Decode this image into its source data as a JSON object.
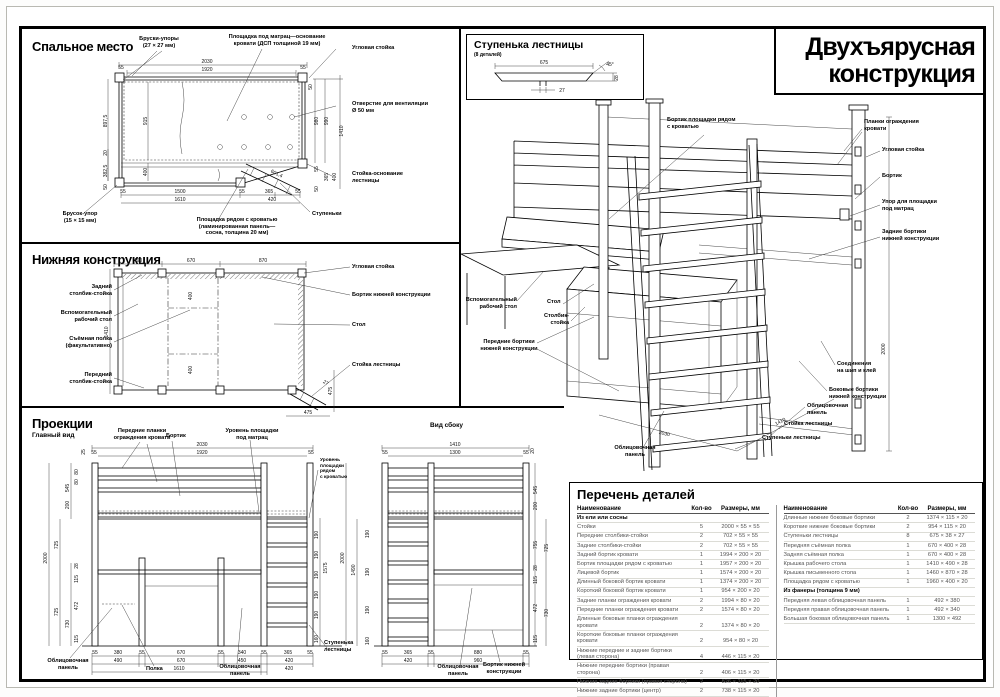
{
  "sheet": {
    "title_line1": "Двухъярусная",
    "title_line2": "конструкция"
  },
  "sleeping": {
    "title": "Спальное место",
    "labels": {
      "bruski_upory": "Бруски-упоры\n(27 × 27 мм)",
      "ploshchadka_matrats": "Площадка под матрац—основание\nкровати (ДСП толщиной 19 мм)",
      "uglovaya_stoyka": "Угловая стойка",
      "otverstie": "Отверстие для вентиляции\nØ 50 мм",
      "stoyka_osnovanie": "Стойка-основание\nлестницы",
      "stupenki": "Ступеньки",
      "brusok_upor": "Брусок-упор\n(15 × 15 мм)",
      "ploshchadka_ryadom": "Площадка рядом с кроватью\n(ламинированная панель—\nсосна, толщина 20 мм)"
    },
    "dims": {
      "w_total": "2030",
      "w_inner": "1920",
      "end55a": "55",
      "end55b": "55",
      "t50": "50",
      "h980": "980",
      "h990": "990",
      "h1410": "1410",
      "r55": "55",
      "r365": "365",
      "r400": "400",
      "r50": "50",
      "l8975": "897,5",
      "l915": "915",
      "l3825": "382,5",
      "l20": "20",
      "l400": "400",
      "l50": "50",
      "b55a": "55",
      "b1500": "1500",
      "b55b": "55",
      "b365": "365",
      "b55c": "55",
      "b1610": "1610",
      "b420": "420",
      "diag": "601,4"
    }
  },
  "lower": {
    "title": "Нижняя конструкция",
    "labels": {
      "zadniy_stolbik": "Задний\nстолбик-стойка",
      "vspom_stol": "Вспомогательный\nрабочий стол",
      "syomnaya_polka": "Съёмная полка\n(факультативно)",
      "peredniy_stolbik": "Передний\nстолбик-стойка",
      "uglovaya_stoyka": "Угловая стойка",
      "bortik_nizhney": "Бортик нижней конструкции",
      "stol": "Стол",
      "stoyka_lestnitsy": "Стойка лестницы"
    },
    "dims": {
      "t490": "490",
      "t670": "670",
      "t870": "870",
      "m400a": "400",
      "m400b": "400",
      "l1410": "1410",
      "r475": "475",
      "b475": "475",
      "d27": "27"
    }
  },
  "projections": {
    "title": "Проекции",
    "main_view": "Главный вид",
    "side_view": "Вид сбоку",
    "labels": {
      "perednie_planki": "Передние планки\nограждения кровати",
      "bortik": "Бортик",
      "uroven_matrats": "Уровень площадки\nпод матрац",
      "uroven_ryadom": "Уровень\nплощадки\nрядом\nс кроватью",
      "oblits_panel_1": "Облицовочная\nпанель",
      "polka": "Полка",
      "oblits_panel_2": "Облицовочная\nпанель",
      "stupenka_lestnitsy": "Ступенька\nлестницы",
      "oblits_panel_3": "Облицовочная\nпанель",
      "bortik_nizhney": "Бортик нижней\nконструкции"
    },
    "main_dims": {
      "t2030": "2030",
      "t1920": "1920",
      "t55l": "55",
      "t55r": "55",
      "t25": "25",
      "l2000": "2000",
      "l725a": "725",
      "l725b": "725",
      "l545": "545",
      "l200": "200",
      "l80": "80",
      "l28": "28",
      "l115a": "115",
      "l472": "472",
      "l115b": "115",
      "l730": "730",
      "rung": "190",
      "r1575": "1575",
      "r160": "160",
      "b55a": "55",
      "b380": "380",
      "b55b": "55",
      "b670": "670",
      "b55c": "55",
      "b340": "340",
      "b55d": "55",
      "b365": "365",
      "b55e": "55",
      "b490": "490",
      "b670b": "670",
      "b450": "450",
      "b420": "420",
      "b1610": "1610",
      "b420b": "420"
    },
    "side_dims": {
      "t1410": "1410",
      "t1300": "1300",
      "t55l": "55",
      "t55r": "55",
      "t20": "20",
      "l2000": "2000",
      "l1490": "1490",
      "rung": "190",
      "l160": "160",
      "r545": "545",
      "r200": "200",
      "r755": "755",
      "r725": "725",
      "r28": "28",
      "r115a": "115",
      "r472": "472",
      "r730": "730",
      "r115b": "115",
      "b55a": "55",
      "b365": "365",
      "b55b": "55",
      "b880": "880",
      "b55c": "55",
      "b420": "420",
      "b960": "960"
    }
  },
  "step_detail": {
    "title": "Ступенька лестницы",
    "subtitle": "(8 деталей)",
    "dims": {
      "w675": "675",
      "t27": "27",
      "a45": "45°",
      "h28": "28"
    }
  },
  "isometric": {
    "labels": {
      "bortik_ploshchadki": "Бортик площадки рядом\nс кроватью",
      "planki_ograzhdeniya": "Планки ограждения\nкровати",
      "uglovaya_stoyka": "Угловая стойка",
      "bortik": "Бортик",
      "upor_ploshchadki": "Упор для площадки\nпод матрац",
      "zadnie_bortiki": "Задние бортики\nнижней конструкции",
      "vspom_stol": "Вспомогательный\nрабочий стол",
      "stol": "Стол",
      "stolbik_stoyka": "Столбик-\nстойка",
      "perednie_bortiki": "Передние бортики\nнижней конструкции",
      "soedineniya": "Соединения\nна шип и клей",
      "bokovye_bortiki": "Боковые бортики\nнижней конструкции",
      "oblitsovochnaya_r": "Облицовочная\nпанель",
      "stoyka_lestnitsy": "Стойка лестницы",
      "stupenki_lestnitsy": "Ступеньки лестницы",
      "oblitsovochnaya_l": "Облицовочная\nпанель"
    },
    "dims": {
      "d2030": "2030",
      "d1410": "1410",
      "d2000": "2000"
    }
  },
  "parts_table": {
    "title": "Перечень деталей",
    "headers": {
      "name": "Наименование",
      "qty": "Кол-во",
      "size": "Размеры, мм"
    },
    "left_rows": [
      {
        "name": "Из ели или сосны",
        "qty": "",
        "size": "",
        "header": true
      },
      {
        "name": "Стойки",
        "qty": "5",
        "size": "2000 × 55 × 55"
      },
      {
        "name": "Передние столбики-стойки",
        "qty": "2",
        "size": "702 × 55 × 55"
      },
      {
        "name": "Задние столбики-стойки",
        "qty": "2",
        "size": "702 × 55 × 55"
      },
      {
        "name": "Задний бортик кровати",
        "qty": "1",
        "size": "1994 × 200 × 20"
      },
      {
        "name": "Бортик площадки рядом с кроватью",
        "qty": "1",
        "size": "1957 × 200 × 20"
      },
      {
        "name": "Лицевой бортик",
        "qty": "1",
        "size": "1574 × 200 × 20"
      },
      {
        "name": "Длинный боковой бортик кровати",
        "qty": "1",
        "size": "1374 × 200 × 20"
      },
      {
        "name": "Короткий боковой бортик кровати",
        "qty": "1",
        "size": "954 × 200 × 20"
      },
      {
        "name": "Задние планки ограждения кровати",
        "qty": "2",
        "size": "1994 × 80 × 20"
      },
      {
        "name": "Передние планки ограждения кровати",
        "qty": "2",
        "size": "1574 × 80 × 20"
      },
      {
        "name": "Длинные боковые планки ограждения кровати",
        "qty": "2",
        "size": "1374 × 80 × 20"
      },
      {
        "name": "Короткие боковые планки ограждения кровати",
        "qty": "2",
        "size": "954 × 80 × 20"
      },
      {
        "name": "Нижние передние и задние бортики (левая сторона)",
        "qty": "4",
        "size": "446 × 115 × 20"
      },
      {
        "name": "Нижние передние бортики (правая сторона)",
        "qty": "2",
        "size": "406 × 115 × 20"
      },
      {
        "name": "Нижние задние бортики (правая сторона)",
        "qty": "2",
        "size": "826 × 115 × 20"
      },
      {
        "name": "Нижние задние бортики (центр)",
        "qty": "2",
        "size": "738 × 115 × 20"
      }
    ],
    "right_rows": [
      {
        "name": "Длинные нижние боковые бортики",
        "qty": "2",
        "size": "1374 × 115 × 20"
      },
      {
        "name": "Короткие нижние боковые бортики",
        "qty": "2",
        "size": "954 × 115 × 20"
      },
      {
        "name": "Ступеньки лестницы",
        "qty": "8",
        "size": "675 × 38 × 27"
      },
      {
        "name": "Передняя съёмная полка",
        "qty": "1",
        "size": "670 × 400 × 28"
      },
      {
        "name": "Задняя съёмная полка",
        "qty": "1",
        "size": "670 × 400 × 28"
      },
      {
        "name": "Крышка рабочего стола",
        "qty": "1",
        "size": "1410 × 490 × 28"
      },
      {
        "name": "Крышка письменного стола",
        "qty": "1",
        "size": "1460 × 870 × 28"
      },
      {
        "name": "Площадка рядом с кроватью",
        "qty": "1",
        "size": "1960 × 400 × 20"
      },
      {
        "name": "Из фанеры (толщина 9 мм)",
        "qty": "",
        "size": "",
        "header": true
      },
      {
        "name": "Передняя левая облицовочная панель",
        "qty": "1",
        "size": "492 × 380"
      },
      {
        "name": "Передняя правая облицовочная панель",
        "qty": "1",
        "size": "492 × 340"
      },
      {
        "name": "Большая боковая облицовочная панель",
        "qty": "1",
        "size": "1300 × 492"
      }
    ]
  }
}
